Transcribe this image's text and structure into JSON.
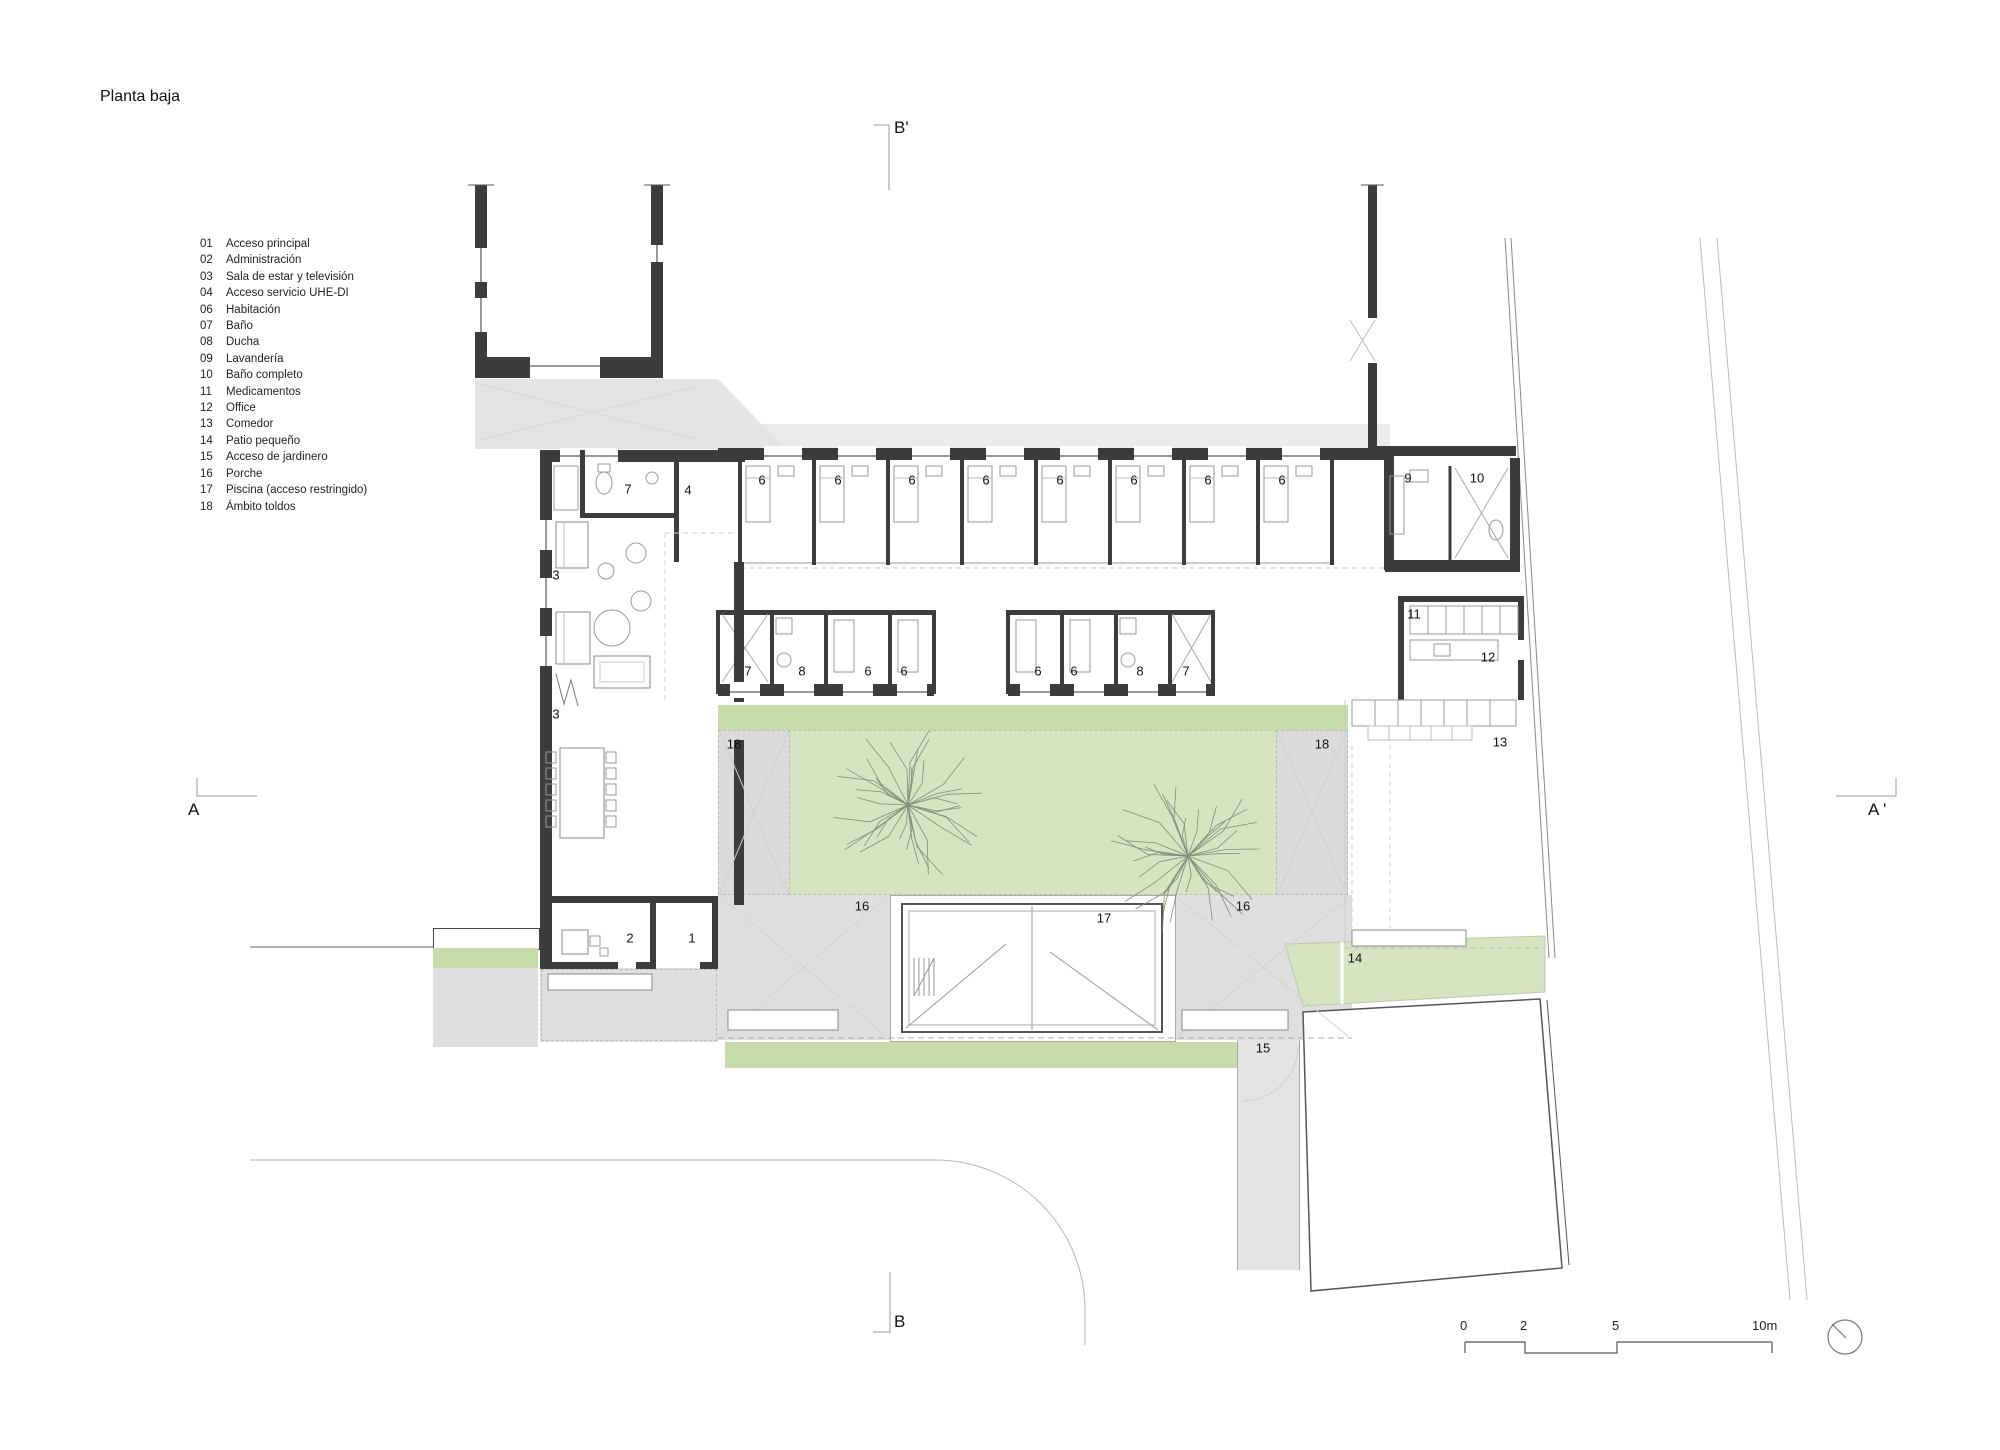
{
  "title": "Planta baja",
  "legend": [
    {
      "num": "01",
      "label": "Acceso principal"
    },
    {
      "num": "02",
      "label": "Administración"
    },
    {
      "num": "03",
      "label": "Sala de estar y televisión"
    },
    {
      "num": "04",
      "label": "Acceso servicio UHE-DI"
    },
    {
      "num": "06",
      "label": "Habitación"
    },
    {
      "num": "07",
      "label": "Baño"
    },
    {
      "num": "08",
      "label": "Ducha"
    },
    {
      "num": "09",
      "label": "Lavandería"
    },
    {
      "num": "10",
      "label": "Baño completo"
    },
    {
      "num": "11",
      "label": "Medicamentos"
    },
    {
      "num": "12",
      "label": "Office"
    },
    {
      "num": "13",
      "label": "Comedor"
    },
    {
      "num": "14",
      "label": "Patio pequeño"
    },
    {
      "num": "15",
      "label": "Acceso de jardinero"
    },
    {
      "num": "16",
      "label": "Porche"
    },
    {
      "num": "17",
      "label": "Piscina (acceso restringido)"
    },
    {
      "num": "18",
      "label": "Ámbito toldos"
    }
  ],
  "sections": {
    "b_top": "B'",
    "b_bottom": "B",
    "a_left": "A",
    "a_right": "A '"
  },
  "scalebar": {
    "ticks": [
      "0",
      "2",
      "5",
      "10m"
    ]
  },
  "room_labels": [
    {
      "t": "6",
      "x": 762,
      "y": 480
    },
    {
      "t": "6",
      "x": 838,
      "y": 480
    },
    {
      "t": "6",
      "x": 912,
      "y": 480
    },
    {
      "t": "6",
      "x": 986,
      "y": 480
    },
    {
      "t": "6",
      "x": 1060,
      "y": 480
    },
    {
      "t": "6",
      "x": 1134,
      "y": 480
    },
    {
      "t": "6",
      "x": 1208,
      "y": 480
    },
    {
      "t": "6",
      "x": 1282,
      "y": 480
    },
    {
      "t": "9",
      "x": 1408,
      "y": 478
    },
    {
      "t": "10",
      "x": 1477,
      "y": 478
    },
    {
      "t": "7",
      "x": 748,
      "y": 671
    },
    {
      "t": "8",
      "x": 802,
      "y": 671
    },
    {
      "t": "6",
      "x": 868,
      "y": 671
    },
    {
      "t": "6",
      "x": 904,
      "y": 671
    },
    {
      "t": "6",
      "x": 1038,
      "y": 671
    },
    {
      "t": "6",
      "x": 1074,
      "y": 671
    },
    {
      "t": "8",
      "x": 1140,
      "y": 671
    },
    {
      "t": "7",
      "x": 1186,
      "y": 671
    },
    {
      "t": "7",
      "x": 628,
      "y": 489
    },
    {
      "t": "4",
      "x": 688,
      "y": 490
    },
    {
      "t": "3",
      "x": 556,
      "y": 575
    },
    {
      "t": "3",
      "x": 556,
      "y": 714
    },
    {
      "t": "11",
      "x": 1414,
      "y": 614
    },
    {
      "t": "12",
      "x": 1488,
      "y": 657
    },
    {
      "t": "13",
      "x": 1500,
      "y": 742
    },
    {
      "t": "18",
      "x": 734,
      "y": 744
    },
    {
      "t": "18",
      "x": 1322,
      "y": 744
    },
    {
      "t": "16",
      "x": 862,
      "y": 906
    },
    {
      "t": "17",
      "x": 1104,
      "y": 918
    },
    {
      "t": "16",
      "x": 1243,
      "y": 906
    },
    {
      "t": "2",
      "x": 630,
      "y": 938
    },
    {
      "t": "1",
      "x": 692,
      "y": 938
    },
    {
      "t": "14",
      "x": 1355,
      "y": 958
    },
    {
      "t": "15",
      "x": 1263,
      "y": 1048
    }
  ],
  "colors": {
    "lawn": "#d6e4c2",
    "lawn_strip": "#c8dcab",
    "paving": "#e4e4e4",
    "porch": "#dfdfdf",
    "wall": "#3c3c3c",
    "tree": "#7f8e76",
    "line": "#b5b5b5"
  }
}
